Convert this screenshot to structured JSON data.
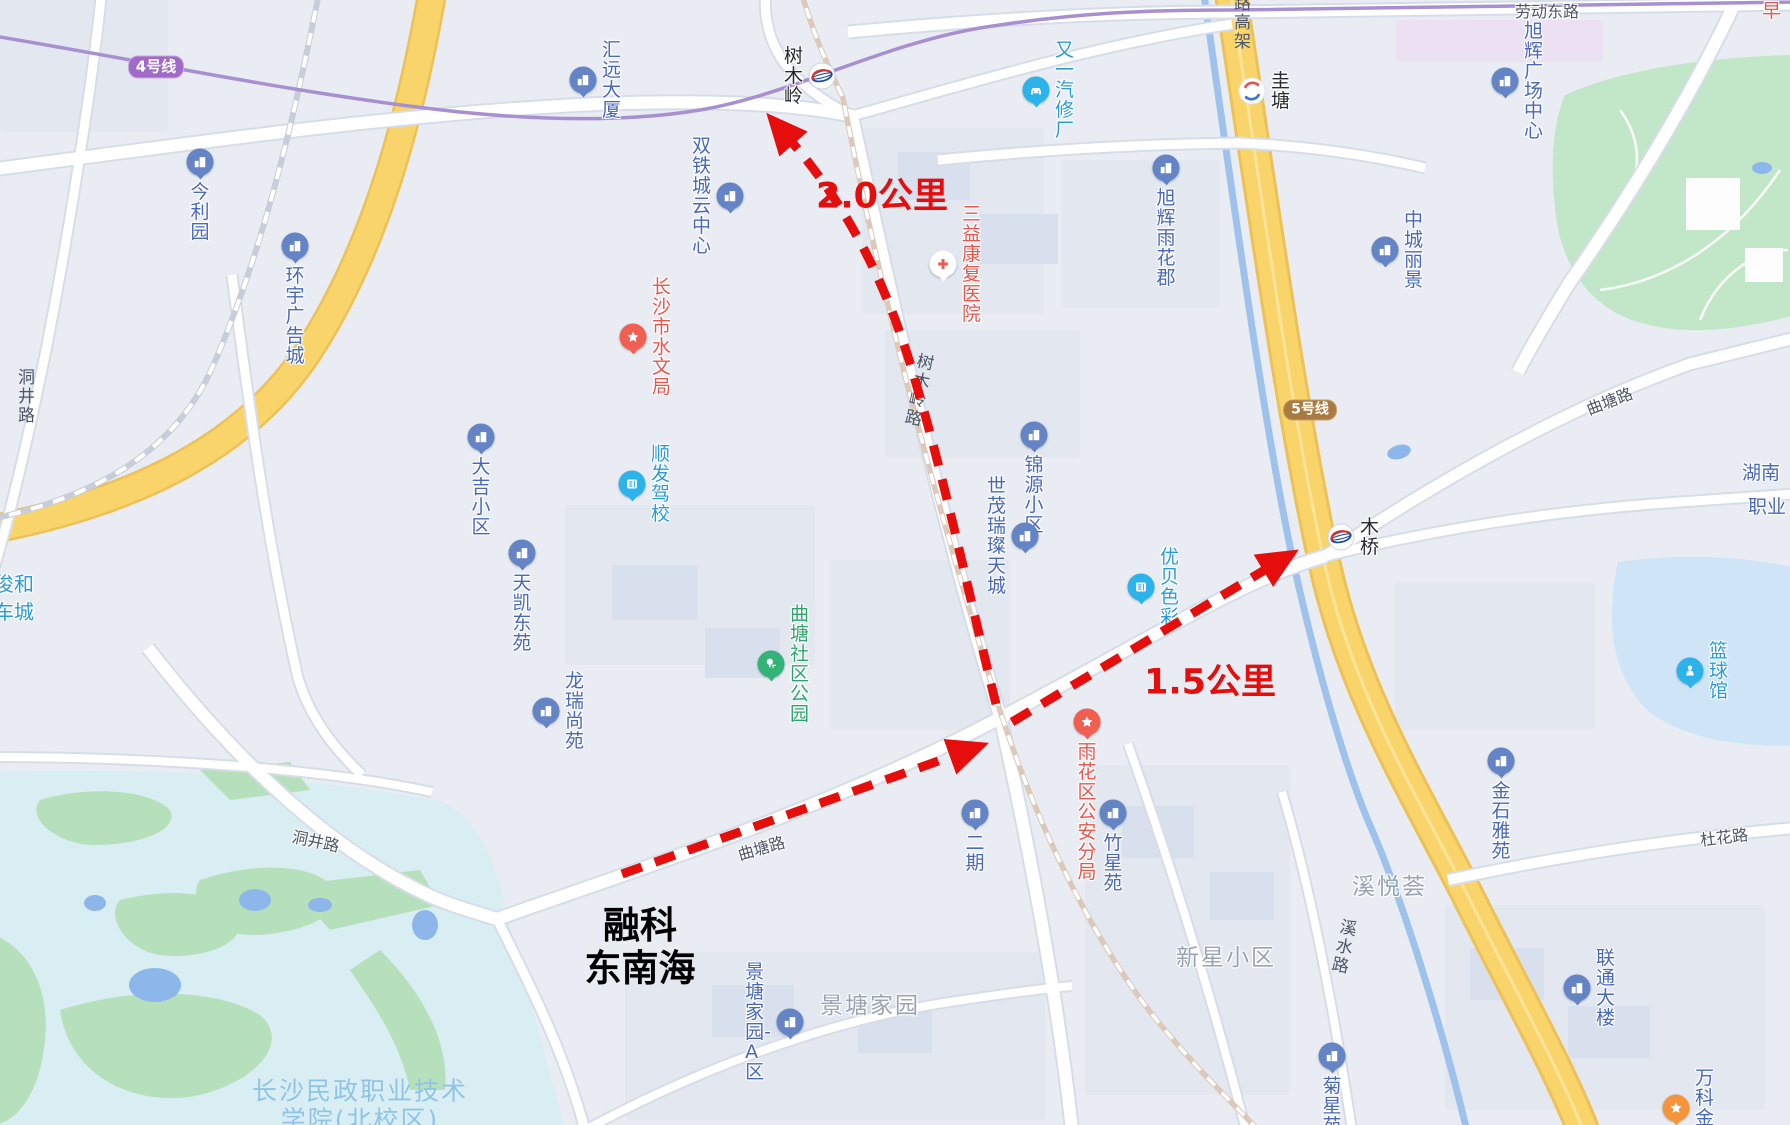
{
  "annotations": {
    "origin_line1": "融科",
    "origin_line2": "东南海",
    "distance_to_shumuling": "2.0公里",
    "distance_to_muqiao": "1.5公里",
    "arrow_color": "#e60d0d"
  },
  "metro": {
    "line4_badge": "4号线",
    "line5_badge": "5号线",
    "line4_color": "#a16ac6",
    "line5_color": "#aa7b41",
    "stations": [
      {
        "name": "树木岭"
      },
      {
        "name": "圭塘"
      },
      {
        "name": "木桥"
      }
    ]
  },
  "roads": {
    "laodong_east": "劳动东路",
    "elevated_partial": "路高架",
    "shumuling_rd": "树木岭路",
    "qutang_rd": "曲塘路",
    "dongjing_rd": "洞井路",
    "duhua_rd": "杜花路",
    "xishui_rd": "溪水路"
  },
  "pois": [
    {
      "name": "今利园",
      "icon": "building-pin",
      "color": "#6484c6"
    },
    {
      "name": "环宇广告城",
      "icon": "building-pin",
      "color": "#6484c6"
    },
    {
      "name": "汇远大厦",
      "icon": "building-pin",
      "color": "#6484c6"
    },
    {
      "name": "双铁城云中心",
      "icon": "building-pin",
      "color": "#6484c6"
    },
    {
      "name": "又一汽修厂",
      "icon": "car-repair-pin",
      "color": "#2cb3ea"
    },
    {
      "name": "旭辉广场中心",
      "icon": "building-pin",
      "color": "#6484c6"
    },
    {
      "name": "三益康复医院",
      "icon": "hospital-cross-pin",
      "color": "#ffffff"
    },
    {
      "name": "旭辉雨花郡",
      "icon": "building-pin",
      "color": "#6484c6"
    },
    {
      "name": "中城丽景",
      "icon": "building-pin",
      "color": "#6484c6"
    },
    {
      "name": "长沙市水文局",
      "icon": "star-pin",
      "color": "#f15f53"
    },
    {
      "name": "大吉小区",
      "icon": "building-pin",
      "color": "#6484c6"
    },
    {
      "name": "顺发驾校",
      "icon": "book-pin",
      "color": "#2cb3ea"
    },
    {
      "name": "锦源小区",
      "icon": "building-pin",
      "color": "#6484c6"
    },
    {
      "name": "世茂瑞璨天城",
      "icon": "building-pin",
      "color": "#6484c6"
    },
    {
      "name": "优贝色彩",
      "icon": "book-pin",
      "color": "#2cb3ea"
    },
    {
      "name": "曲塘社区公园",
      "icon": "park-tree-pin",
      "color": "#33b377"
    },
    {
      "name": "天凯东苑",
      "icon": "building-pin",
      "color": "#6484c6"
    },
    {
      "name": "龙瑞尚苑",
      "icon": "building-pin",
      "color": "#6484c6"
    },
    {
      "name": "雨花区公安分局",
      "icon": "star-pin",
      "color": "#f15f53"
    },
    {
      "name": "二期",
      "icon": "building-pin",
      "color": "#6484c6"
    },
    {
      "name": "竹星苑",
      "icon": "building-pin",
      "color": "#6484c6"
    },
    {
      "name": "景塘家园-A区",
      "icon": "building-pin",
      "color": "#6484c6"
    },
    {
      "name": "金石雅苑",
      "icon": "building-pin",
      "color": "#6484c6"
    },
    {
      "name": "联通大楼",
      "icon": "building-pin",
      "color": "#6484c6"
    },
    {
      "name": "菊星苑",
      "icon": "building-pin",
      "color": "#6484c6"
    },
    {
      "name": "万科金域",
      "icon": "star-pin",
      "color": "#f5953b"
    },
    {
      "name": "篮球馆",
      "icon": "person-pin",
      "color": "#2cb3ea"
    }
  ],
  "areas": {
    "jingtang": "景塘家园",
    "xinxing": "新星小区",
    "xiyuehui": "溪悦荟",
    "college_line1": "长沙民政职业技术",
    "college_line2": "学院(北校区)",
    "partial_right_line1": "湖南",
    "partial_right_line2": "职业",
    "partial_left_line1": "南俊和",
    "partial_left_line2": "手车城",
    "partial_top_right": "早"
  },
  "colors": {
    "map_background": "#e9edf3",
    "yellow_road": "#f8d46a",
    "water": "#9fc2ed",
    "park_green": "#c2e6c8",
    "campus": "#d9eef3",
    "poi_blue_text": "#4a68b8",
    "poi_cyan_text": "#2b9bd8",
    "poi_red_text": "#e8564c",
    "area_gray_text": "#98a3b6"
  }
}
